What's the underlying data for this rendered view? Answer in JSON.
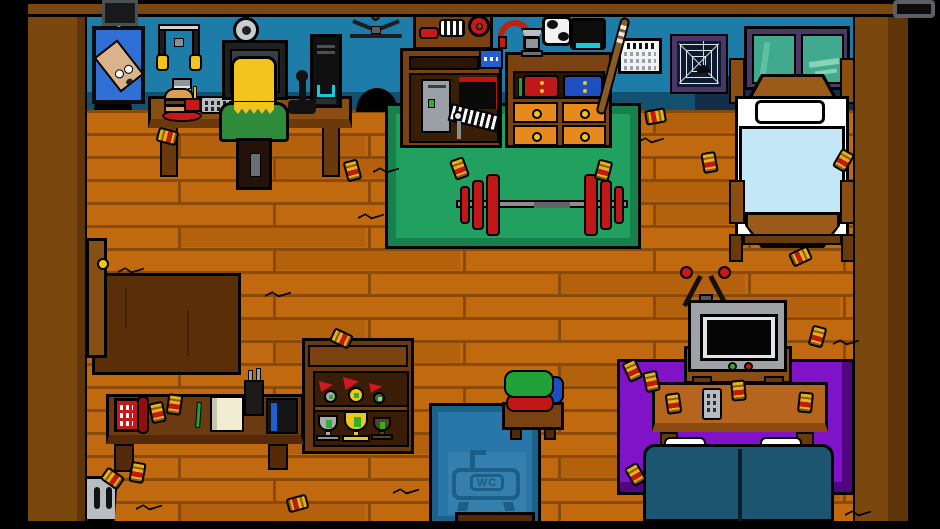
{
  "scene": {
    "name": "top-down apartment room",
    "wc_label": "WC"
  },
  "colors": {
    "floor": "#C1690E",
    "floor_seam": "#8A4A08",
    "wall": "#1E7CA8",
    "wall_base": "#14506F",
    "bed_wall": "#122E48",
    "frame_wood": "#7A480F",
    "frame_wood_dark": "#5E3409",
    "mat_green": "#21A060",
    "mat_green_border": "#17804C",
    "rug_purple": "#8012C8",
    "rug_purple_dark": "#50067F",
    "rug_dark": "#5A2E08",
    "bath_blue": "#2877A8",
    "bath_border": "#1C608C",
    "bath_icon": "#1B5E87",
    "couch_teal": "#1B5570",
    "accent_red": "#C81818",
    "drawer_orange": "#E8891E",
    "knob_yellow": "#F2C41D",
    "can_gold": "#E8B018",
    "can_band": "#C21A10",
    "blanket_blue": "#C4E7F8",
    "window_glass": "#41A98E",
    "window_frame": "#4A3A66"
  },
  "floor": {
    "left": 83,
    "top": 110,
    "width": 774,
    "height": 412,
    "row_h": 23,
    "plank_w": 190
  },
  "cans": [
    [
      160,
      126,
      -75
    ],
    [
      345,
      160,
      -15
    ],
    [
      452,
      158,
      -20
    ],
    [
      596,
      160,
      15
    ],
    [
      648,
      106,
      80
    ],
    [
      702,
      152,
      -10
    ],
    [
      793,
      246,
      65
    ],
    [
      810,
      326,
      15
    ],
    [
      625,
      360,
      -25
    ],
    [
      644,
      371,
      -12
    ],
    [
      628,
      464,
      -30
    ],
    [
      290,
      493,
      75
    ],
    [
      334,
      328,
      -65
    ],
    [
      150,
      402,
      -12
    ],
    [
      167,
      394,
      8
    ],
    [
      666,
      393,
      -8
    ],
    [
      731,
      380,
      -5
    ],
    [
      798,
      392,
      6
    ],
    [
      105,
      468,
      -55
    ],
    [
      130,
      462,
      10
    ],
    [
      836,
      150,
      30
    ]
  ],
  "cracks": [
    [
      118,
      266
    ],
    [
      265,
      290
    ],
    [
      373,
      166
    ],
    [
      638,
      136
    ],
    [
      833,
      338
    ],
    [
      393,
      487
    ],
    [
      136,
      503
    ],
    [
      358,
      212
    ],
    [
      845,
      509
    ]
  ]
}
